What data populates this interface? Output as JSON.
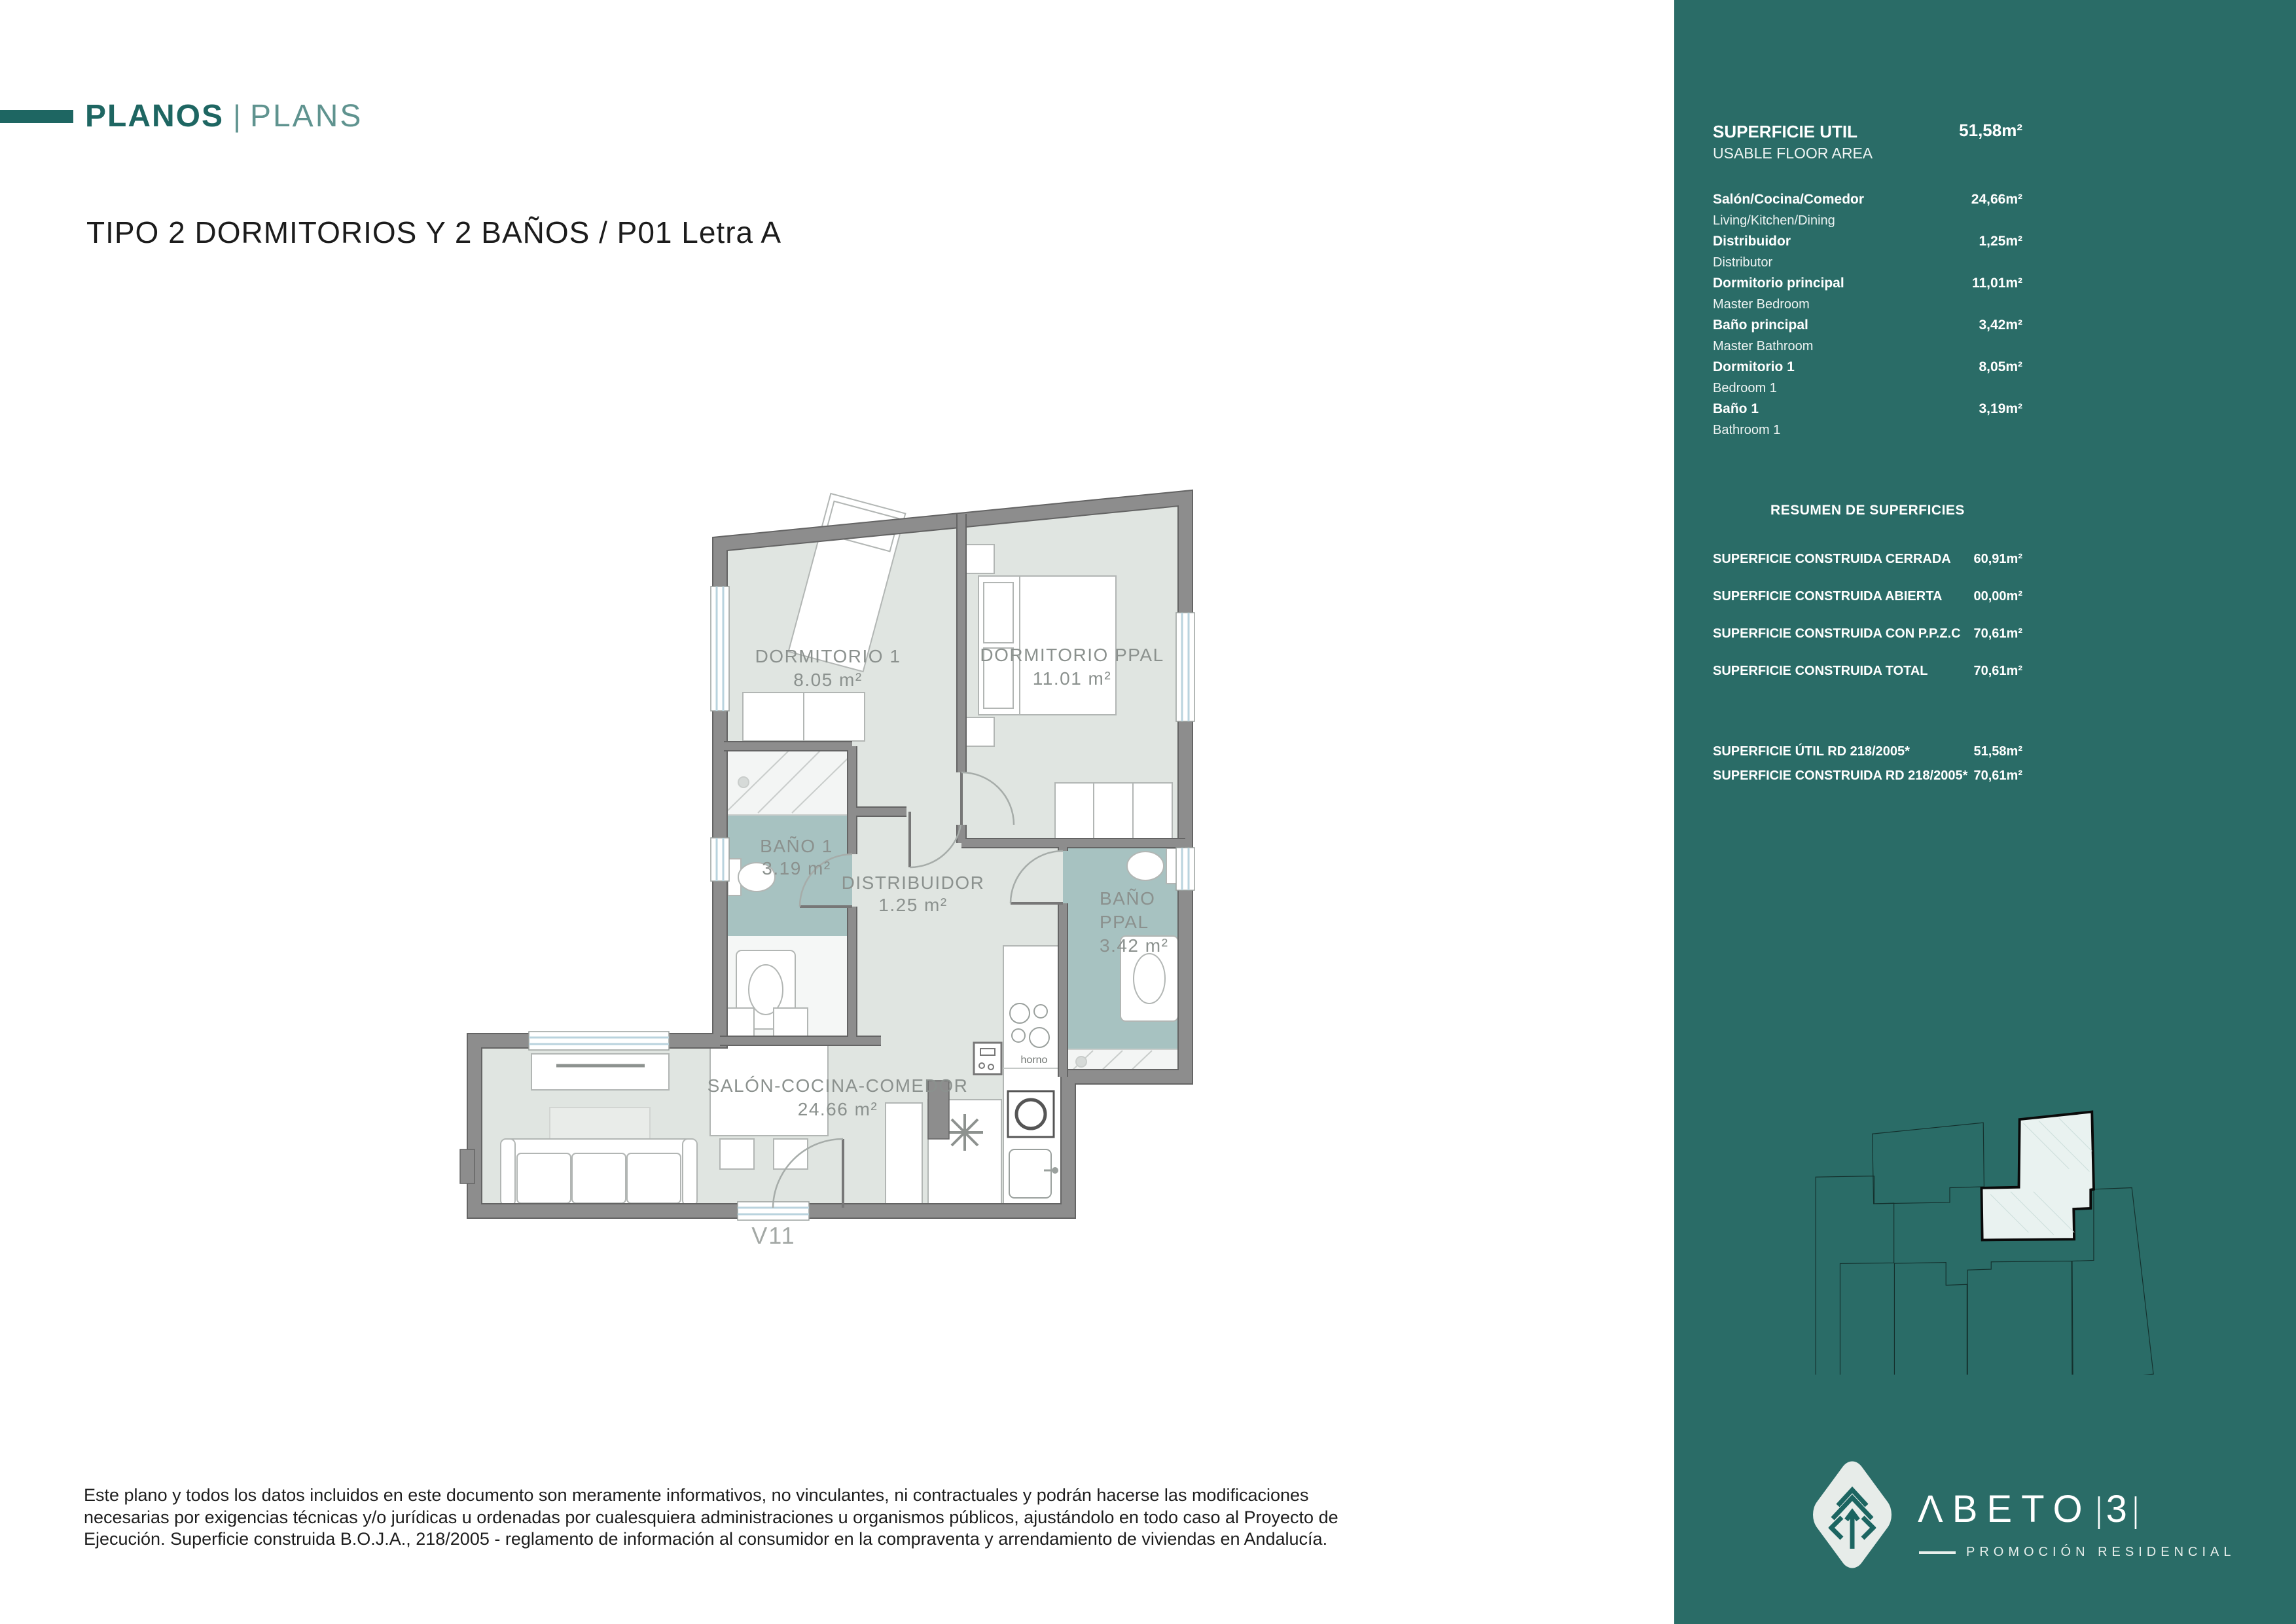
{
  "header": {
    "brand_primary": "PLANOS",
    "brand_divider": "|",
    "brand_secondary": "PLANS",
    "title": "TIPO 2 DORMITORIOS Y 2 BAÑOS / P01 Letra A"
  },
  "plan": {
    "rooms": {
      "dorm1": {
        "name": "DORMITORIO 1",
        "area": "8.05 m²"
      },
      "dormppal": {
        "name": "DORMITORIO PPAL",
        "area": "11.01 m²"
      },
      "bano1": {
        "name": "BAÑO 1",
        "area": "3.19 m²"
      },
      "distribuidor": {
        "name": "DISTRIBUIDOR",
        "area": "1.25 m²"
      },
      "banoppal": {
        "name_line1": "BAÑO",
        "name_line2": "PPAL",
        "area": "3.42 m²"
      },
      "salon": {
        "name": "SALÓN-COCINA-COMEDOR",
        "area": "24.66 m²"
      }
    },
    "annotations": {
      "oven": "horno",
      "window": "V11"
    }
  },
  "panel": {
    "usable": {
      "label_es": "SUPERFICIE UTIL",
      "label_en": "USABLE FLOOR AREA",
      "value": "51,58m²"
    },
    "rooms": [
      {
        "es": "Salón/Cocina/Comedor",
        "en": "Living/Kitchen/Dining",
        "value": "24,66m²"
      },
      {
        "es": "Distribuidor",
        "en": "Distributor",
        "value": "1,25m²"
      },
      {
        "es": "Dormitorio principal",
        "en": "Master Bedroom",
        "value": "11,01m²"
      },
      {
        "es": "Baño principal",
        "en": "Master Bathroom",
        "value": "3,42m²"
      },
      {
        "es": "Dormitorio 1",
        "en": "Bedroom 1",
        "value": "8,05m²"
      },
      {
        "es": "Baño 1",
        "en": "Bathroom 1",
        "value": "3,19m²"
      }
    ],
    "summary": {
      "heading": "RESUMEN DE SUPERFICIES",
      "rows": [
        {
          "label": "SUPERFICIE CONSTRUIDA CERRADA",
          "value": "60,91m²"
        },
        {
          "label": "SUPERFICIE CONSTRUIDA ABIERTA",
          "value": "00,00m²"
        },
        {
          "label": "SUPERFICIE CONSTRUIDA CON P.P.Z.C",
          "value": "70,61m²"
        },
        {
          "label": "SUPERFICIE CONSTRUIDA TOTAL",
          "value": "70,61m²"
        }
      ]
    },
    "rd_rows": [
      {
        "label": "SUPERFICIE ÚTIL RD 218/2005*",
        "value": "51,58m²"
      },
      {
        "label": "SUPERFICIE CONSTRUIDA RD 218/2005*",
        "value": "70,61m²"
      }
    ]
  },
  "footer": {
    "disclaimer": "Este plano y todos los datos incluidos en este documento son meramente informativos, no vinculantes, ni contractuales y podrán hacerse las modificaciones necesarias por exigencias técnicas y/o jurídicas u ordenadas por cualesquiera administraciones u organismos públicos, ajustándolo en todo caso al Proyecto de Ejecución. Superficie construida B.O.J.A., 218/2005 - reglamento de información al consumidor en la compraventa y arrendamiento de viviendas en Andalucía."
  },
  "logo": {
    "name": "ΛBETO",
    "divider1": "|",
    "number": "3",
    "divider2": "|",
    "tagline": "PROMOCIÓN RESIDENCIAL"
  },
  "colors": {
    "panel_teal": "#2a6c67",
    "accent_teal": "#1e6662",
    "bathroom_fill": "#a7c2c1",
    "floor_fill": "#e0e5e1",
    "wall_gray": "#8d8d8d"
  }
}
